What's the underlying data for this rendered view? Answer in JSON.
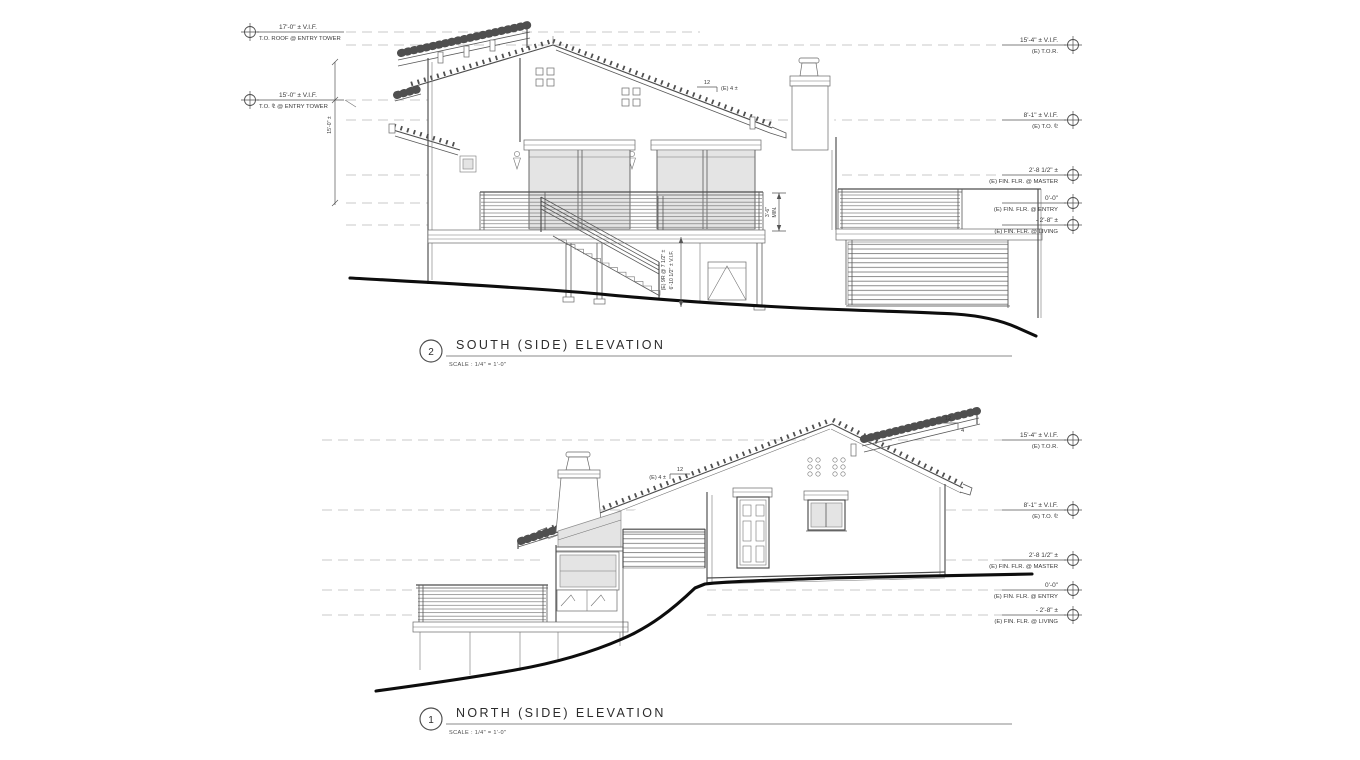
{
  "sheet": {
    "background": "#ffffff",
    "line_color": "#4d4d4d",
    "datum_line_color": "#c9c9c9",
    "grade_line_color": "#0d0d0d",
    "glass_color": "#e4e4e4"
  },
  "south": {
    "number": "2",
    "title": "SOUTH (SIDE) ELEVATION",
    "scale": "SCALE : 1/4\" = 1'-0\"",
    "left_datums": [
      {
        "value": "17'-0\" ± V.I.F.",
        "label": "T.O. ROOF @ ENTRY TOWER"
      },
      {
        "value": "15'-0\" ± V.I.F.",
        "label": "T.O. ⅊ @ ENTRY TOWER"
      }
    ],
    "right_datums": [
      {
        "value": "15'-4\" ± V.I.F.",
        "label": "(E) T.O.R."
      },
      {
        "value": "8'-1\" ± V.I.F.",
        "label": "(E) T.O. ⅊"
      },
      {
        "value": "2'-8 1/2\" ±",
        "label": "(E) FIN. FLR. @ MASTER"
      },
      {
        "value": "0'-0\"",
        "label": "(E) FIN. FLR. @ ENTRY"
      },
      {
        "value": "- 2'-8\" ±",
        "label": "(E) FIN. FLR. @ LIVING"
      }
    ],
    "pitch": {
      "run": "12",
      "rise": "(E) 4 ±"
    },
    "dims": {
      "tower": "15'-0\" ±",
      "rail": "3'-6\"",
      "rail2": "MIN.",
      "stair1": "(E) 9R @ 7 1/2\" ±",
      "stair2": "6'-10 1/2\" ± V.I.F."
    }
  },
  "north": {
    "number": "1",
    "title": "NORTH (SIDE) ELEVATION",
    "scale": "SCALE : 1/4\" = 1'-0\"",
    "right_datums": [
      {
        "value": "15'-4\" ± V.I.F.",
        "label": "(E) T.O.R."
      },
      {
        "value": "8'-1\" ± V.I.F.",
        "label": "(E) T.O. ⅊"
      },
      {
        "value": "2'-8 1/2\" ±",
        "label": "(E) FIN. FLR. @ MASTER"
      },
      {
        "value": "0'-0\"",
        "label": "(E) FIN. FLR. @ ENTRY"
      },
      {
        "value": "- 2'-8\" ±",
        "label": "(E) FIN. FLR. @ LIVING"
      }
    ],
    "pitch_left": {
      "rise": "(E) 4 ±",
      "run": "12"
    },
    "pitch_right": {
      "run": "12",
      "rise": "4"
    }
  }
}
